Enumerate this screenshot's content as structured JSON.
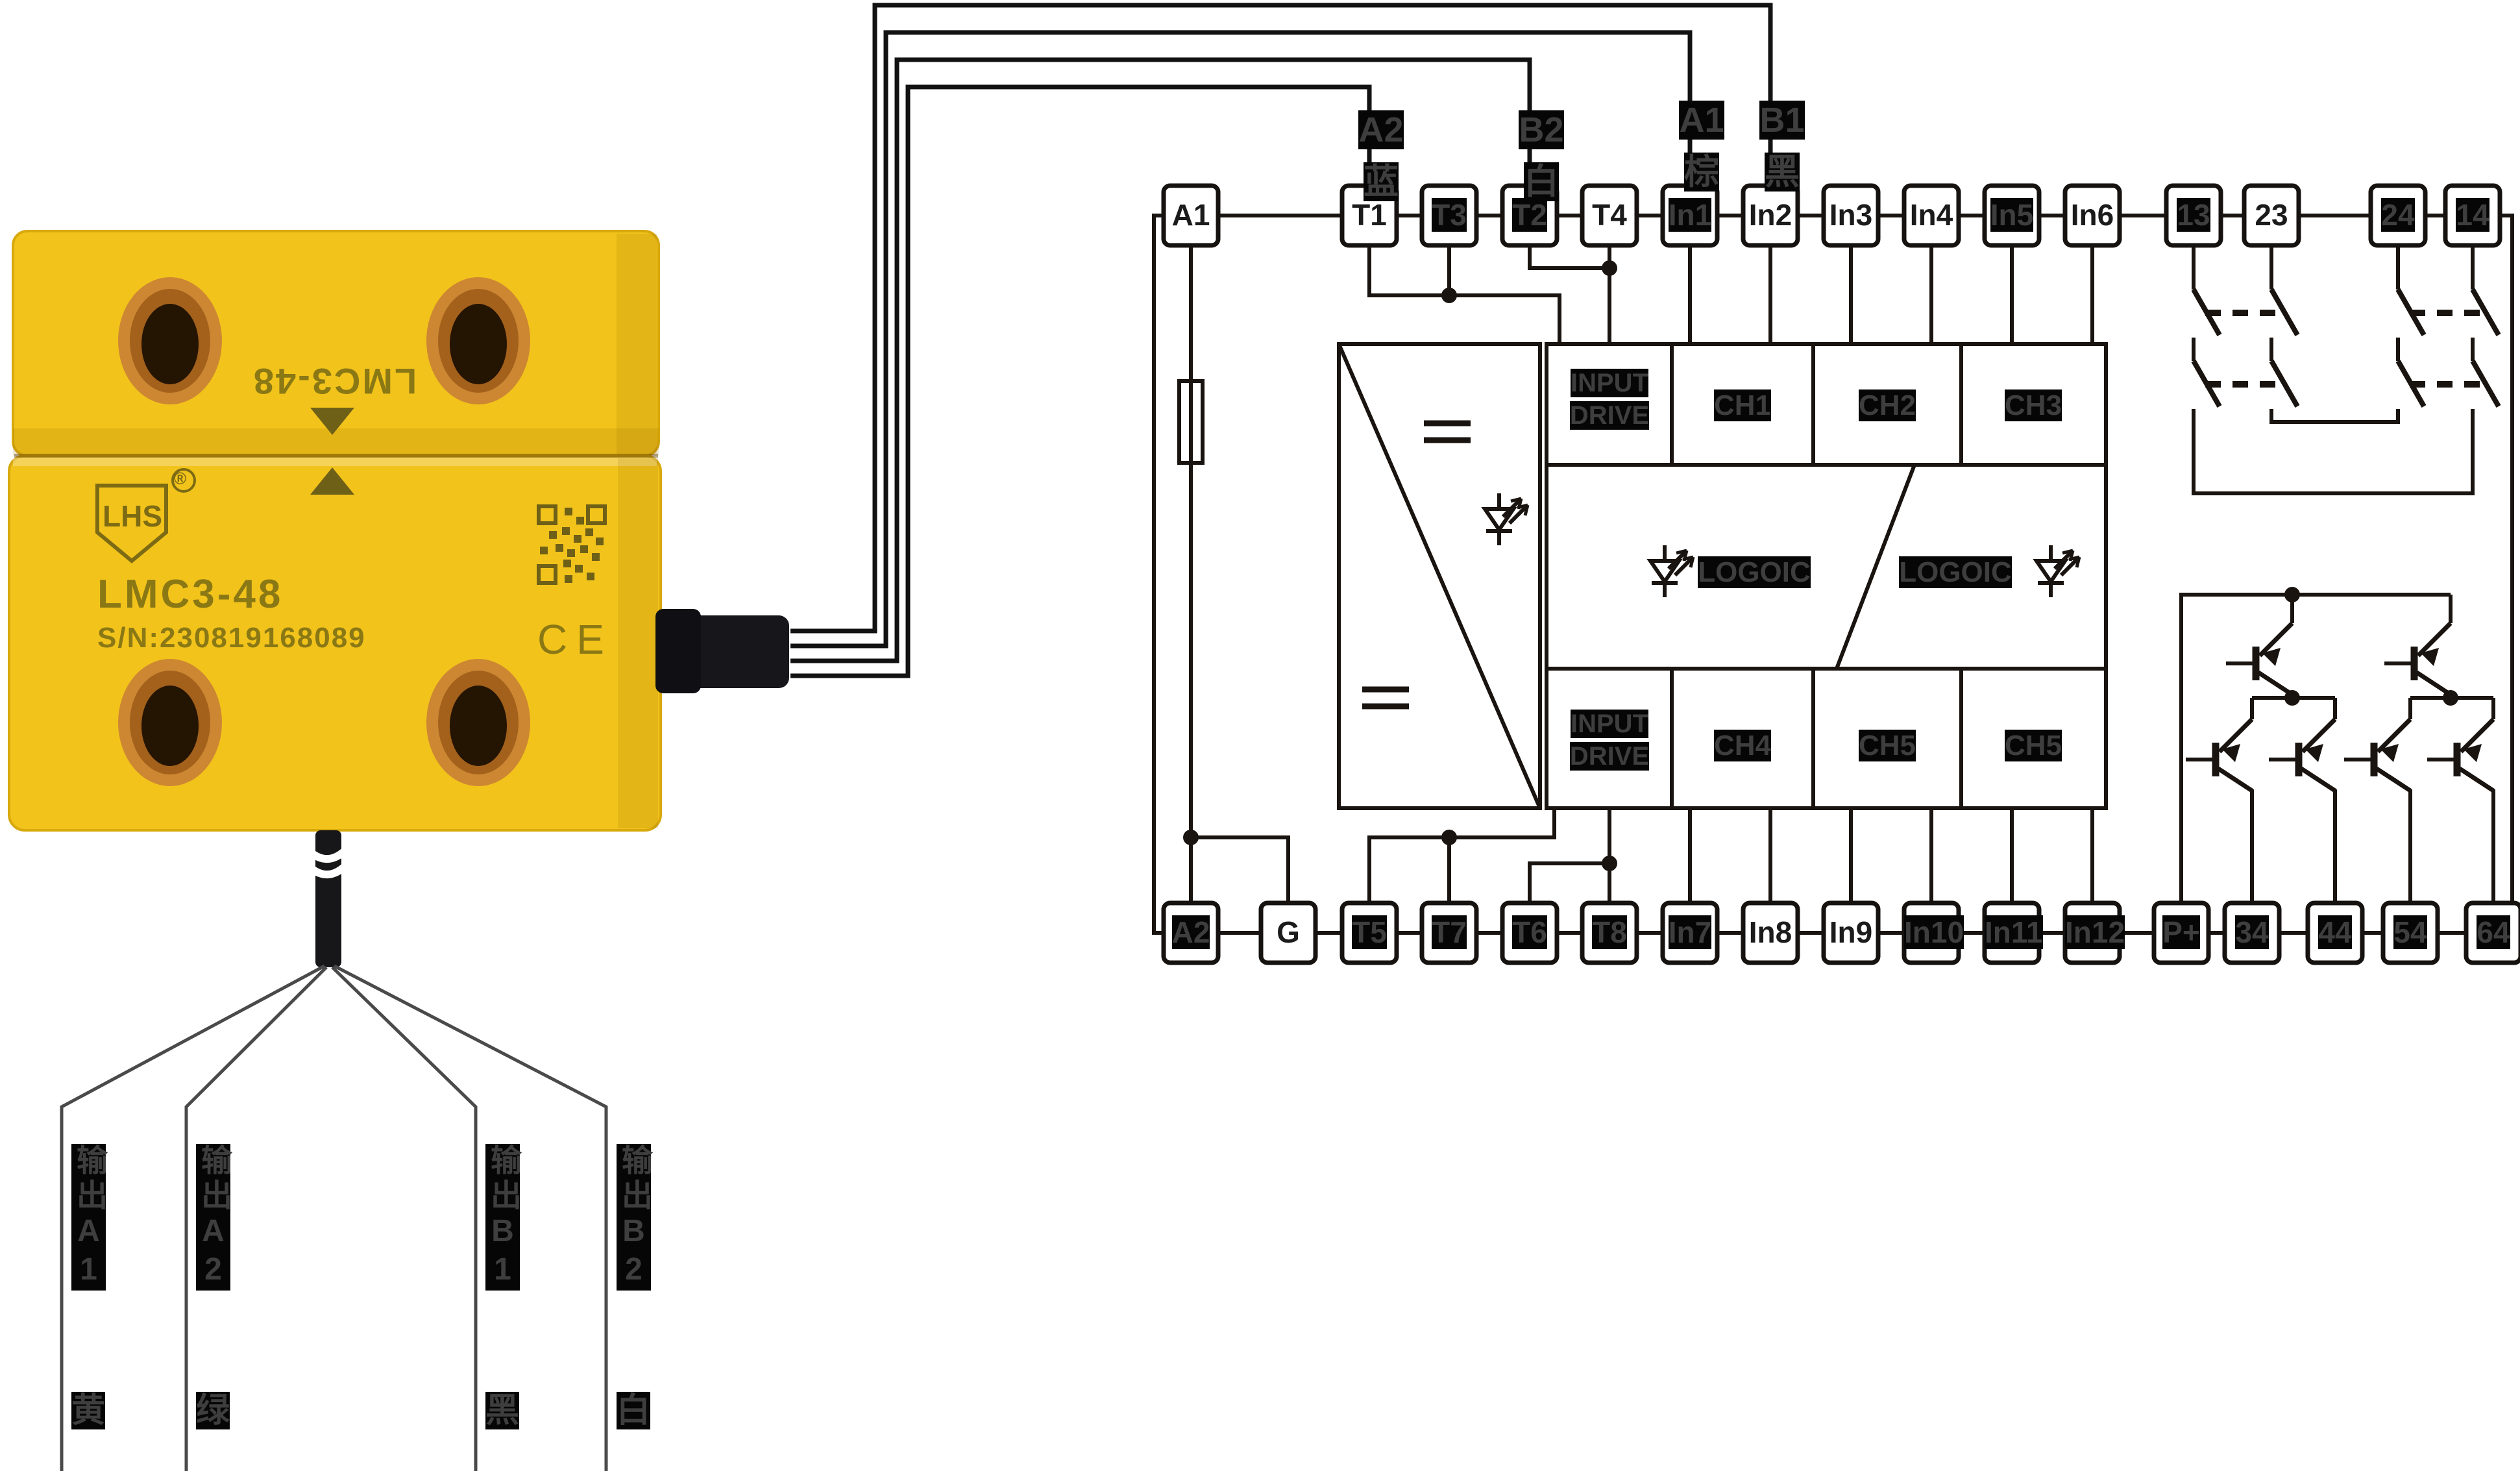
{
  "page": {
    "background": "#ffffff"
  },
  "device": {
    "brand": "LHS",
    "registered_mark": "®",
    "model": "LMC3-48",
    "model_top": "LMC3-48",
    "serial": "S/N:230819168089",
    "ce_mark": "CE"
  },
  "top_wires": [
    {
      "terminal": "A2",
      "color_char": "蓝",
      "connects_to": "T1"
    },
    {
      "terminal": "B2",
      "color_char": "白",
      "connects_to": "T2"
    },
    {
      "terminal": "A1",
      "color_char": "棕",
      "connects_to": "In1"
    },
    {
      "terminal": "B1",
      "color_char": "黑",
      "connects_to": "In2"
    }
  ],
  "output_wires": [
    {
      "label": "输出A1",
      "color_char": "黄"
    },
    {
      "label": "输出A2",
      "color_char": "绿"
    },
    {
      "label": "输出B1",
      "color_char": "黑"
    },
    {
      "label": "输出B2",
      "color_char": "白"
    }
  ],
  "schematic": {
    "top_terminals": [
      {
        "label": "A1",
        "hl": false
      },
      {
        "label": "T1",
        "hl": false
      },
      {
        "label": "T3",
        "hl": true
      },
      {
        "label": "T2",
        "hl": true
      },
      {
        "label": "T4",
        "hl": false
      },
      {
        "label": "In1",
        "hl": true
      },
      {
        "label": "In2",
        "hl": false
      },
      {
        "label": "In3",
        "hl": false
      },
      {
        "label": "In4",
        "hl": false
      },
      {
        "label": "In5",
        "hl": true
      },
      {
        "label": "In6",
        "hl": false
      },
      {
        "label": "13",
        "hl": true
      },
      {
        "label": "23",
        "hl": false
      },
      {
        "label": "24",
        "hl": true
      },
      {
        "label": "14",
        "hl": true
      }
    ],
    "bottom_terminals": [
      {
        "label": "A2",
        "hl": true
      },
      {
        "label": "G",
        "hl": false
      },
      {
        "label": "T5",
        "hl": true
      },
      {
        "label": "T7",
        "hl": true
      },
      {
        "label": "T6",
        "hl": true
      },
      {
        "label": "T8",
        "hl": true
      },
      {
        "label": "In7",
        "hl": true
      },
      {
        "label": "In8",
        "hl": false
      },
      {
        "label": "In9",
        "hl": false
      },
      {
        "label": "In10",
        "hl": true
      },
      {
        "label": "In11",
        "hl": true
      },
      {
        "label": "In12",
        "hl": true
      },
      {
        "label": "P+",
        "hl": true
      },
      {
        "label": "34",
        "hl": true
      },
      {
        "label": "44",
        "hl": true
      },
      {
        "label": "54",
        "hl": true
      },
      {
        "label": "64",
        "hl": true
      }
    ],
    "blocks": {
      "input_drive_top": "INPUT DRIVE",
      "ch1": "CH1",
      "ch2": "CH2",
      "ch3": "CH3",
      "logic_left": "LOGOIC",
      "logic_right": "LOGOIC",
      "input_drive_bottom": "INPUT DRIVE",
      "ch4": "CH4",
      "ch5": "CH5",
      "ch6": "CH5"
    }
  },
  "colors": {
    "device_yellow": "#f2c31b",
    "hole_ring": "#cd8733",
    "engraving": "#8a7815",
    "schematic_line": "#1a1410",
    "label_hl_bg": "#060606",
    "label_hl_fg": "#3e3e3e"
  }
}
